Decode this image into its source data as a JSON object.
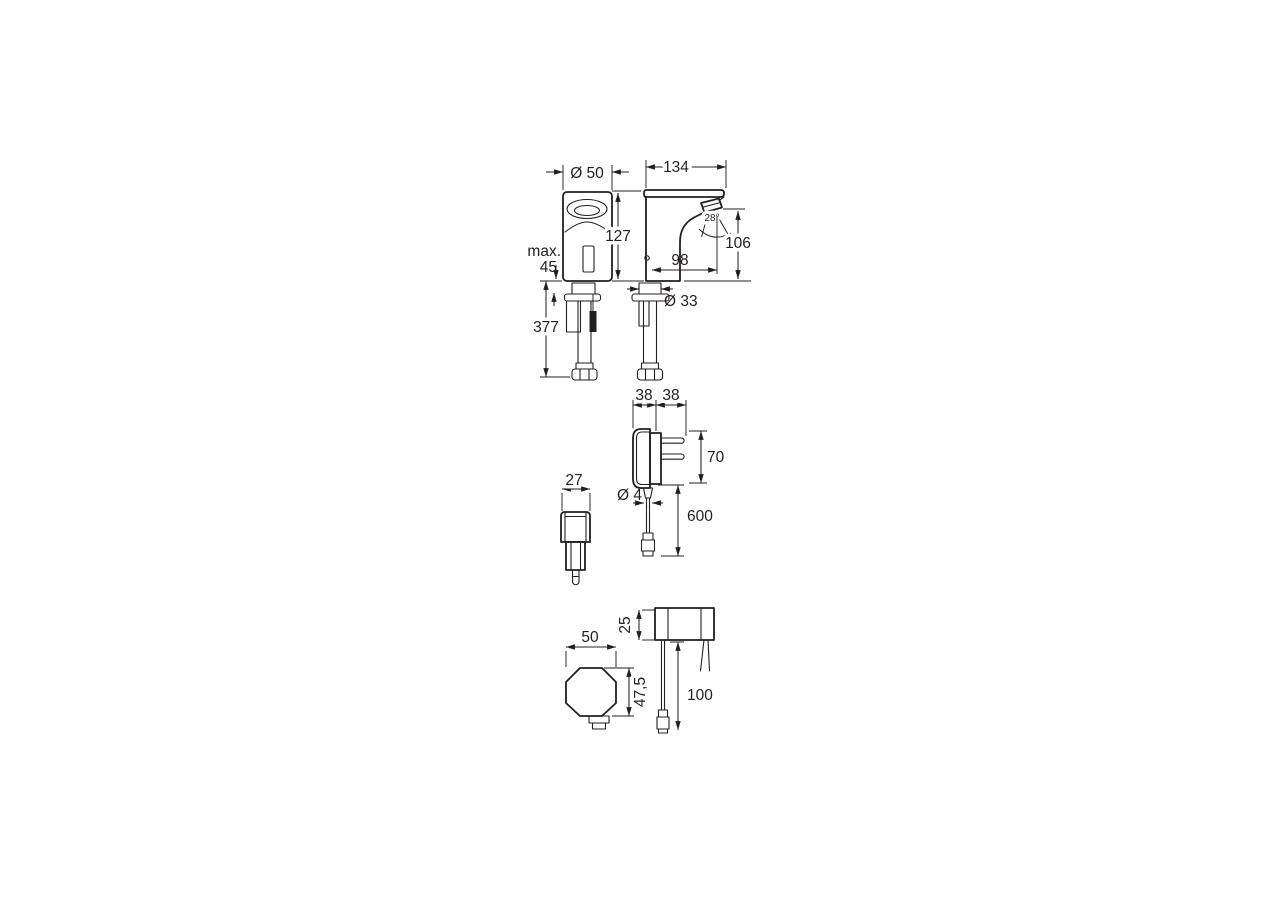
{
  "page": {
    "background": "#ffffff",
    "line_color": "#231f20"
  },
  "views": {
    "faucet_front": {
      "diameter": "Ø 50",
      "max_label": "max.",
      "max_value": "45",
      "install_depth": "377"
    },
    "faucet_side": {
      "width": "134",
      "height": "127",
      "outlet_height": "106",
      "reach": "98",
      "spray_angle": "28°",
      "shank_diameter": "Ø 33"
    },
    "power_supply_side": {
      "body_width": "38",
      "pin_depth": "38",
      "height": "70",
      "cable_diameter": "Ø 4",
      "cable_length": "600"
    },
    "power_supply_front": {
      "width": "27"
    },
    "control_box_top": {
      "width": "50",
      "depth": "47,5"
    },
    "control_box_side": {
      "height": "25",
      "cable_length": "100"
    }
  }
}
